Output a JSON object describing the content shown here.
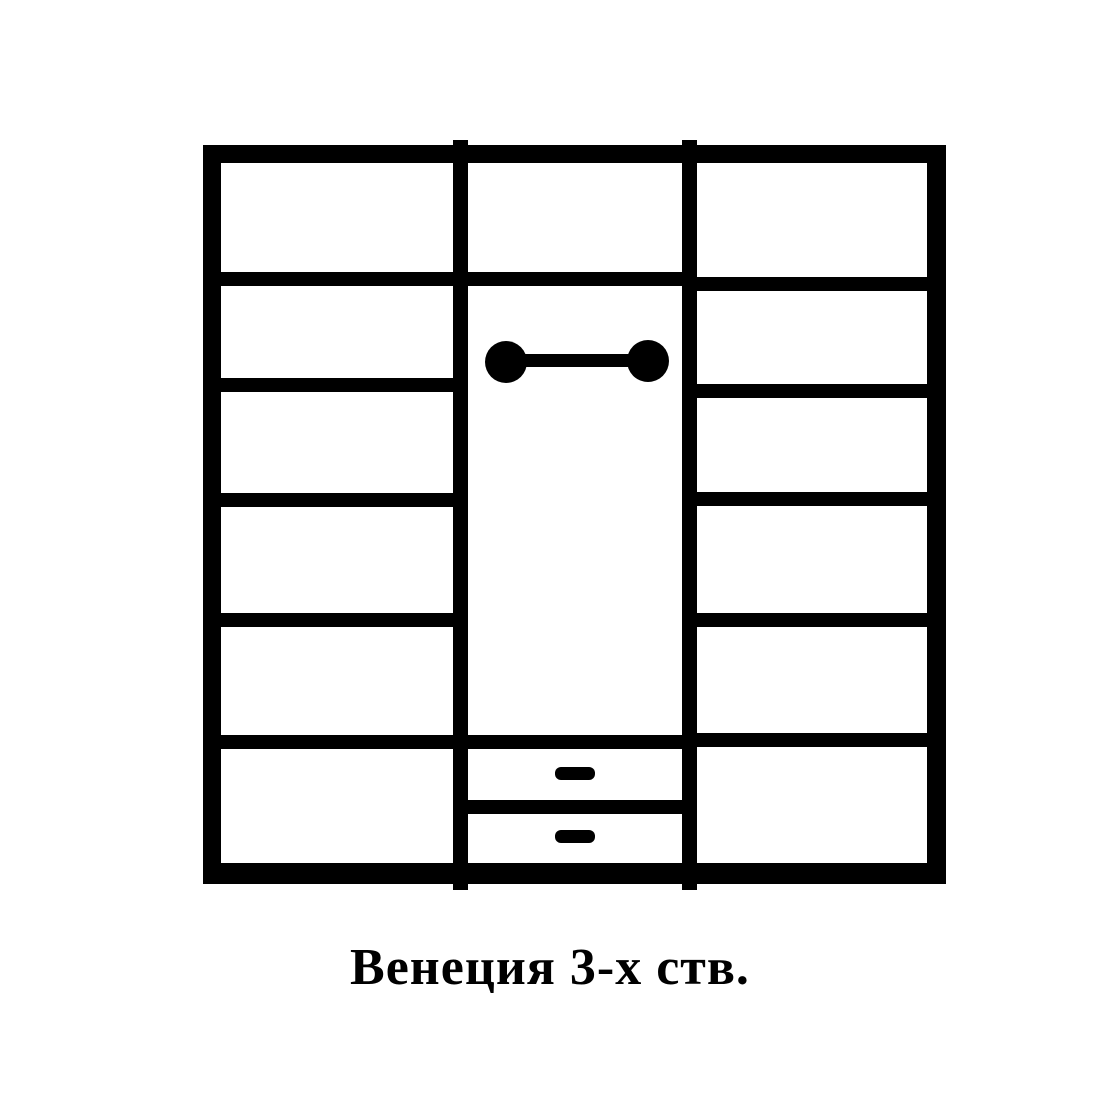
{
  "page": {
    "background_color": "#ffffff",
    "line_color": "#000000"
  },
  "caption": {
    "text": "Венеция 3-х ств."
  },
  "diagram": {
    "type": "wardrobe-front-view-schematic",
    "product_name": "Венеция 3-х ств.",
    "doors": 3,
    "sections": [
      {
        "position": "left",
        "shelves": 5,
        "compartments": 6
      },
      {
        "position": "middle",
        "top_compartments": 1,
        "hanger_rod": true,
        "hanging_space": true,
        "drawers": 2,
        "drawer_handles": 2
      },
      {
        "position": "right",
        "shelves": 5,
        "compartments": 6
      }
    ]
  }
}
